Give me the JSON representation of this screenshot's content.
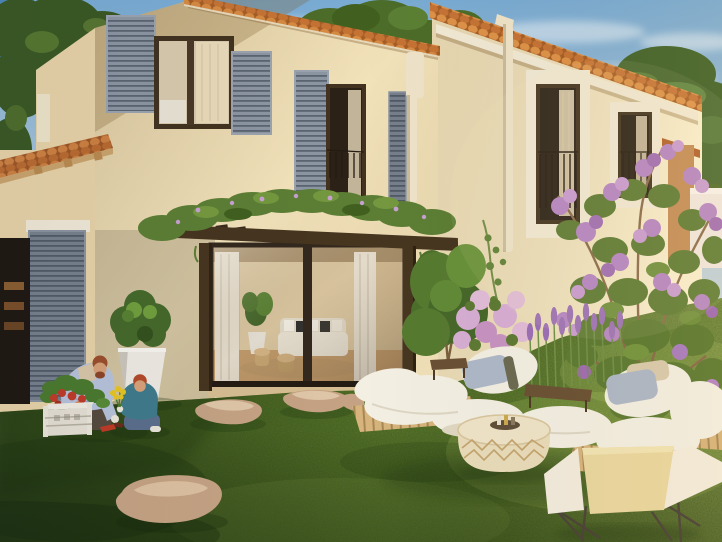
{
  "meta": {
    "type": "architectural-exterior-rendering",
    "description": "3D render of a cream Provencal villa with terracotta tile roof edges, grey louvred shutters, a plant-covered dark-wood pergola over sliding glass doors showing a lit living room, a lawn with stepping stones, a father and son planting flowers by a white crate planter and a tall white pot with a boxwood ball, and a low pallet lounge with white cushions, a woven pouf and a cream sling chair beside lavender and a purple flowering shrub under a blue sky with an umbrella pine."
  },
  "palette": {
    "sky_deep": "#4c88b8",
    "sky_top": "#79abd3",
    "sky_mid": "#b9cedd",
    "sky_horizon": "#e9e0cf",
    "cloud": "#ffffff",
    "tree_dark": "#3a5722",
    "tree_mid": "#4c6c29",
    "tree_light": "#5f8434",
    "pine_green": "#45662e",
    "wall_front": "#f2e2ba",
    "wall_side": "#e7d2a6",
    "wall_right": "#f7ecca",
    "roof_tile": "#cd8040",
    "roof_tile_dark": "#a35d28",
    "cornice": "#f1e9d4",
    "shutter_grey": "#8c95a2",
    "shutter_dark": "#767f8b",
    "window_frame": "#42321f",
    "window_glass": "#2b2117",
    "curtain": "#e9d9ba",
    "pipe": "#eee3c8",
    "pergola_wood": "#46351f",
    "pergola_plants": "#5c7e34",
    "interior_wall": "#d3bc94",
    "interior_floor": "#c29b6b",
    "grass_mid": "#55722a",
    "grass_dark": "#31491a",
    "grass_light": "#7e9a3c",
    "stone": "#c5a283",
    "planter_white": "#eeeae2",
    "bush_green": "#45682a",
    "skin": "#d8a178",
    "hair_man": "#9a4e2b",
    "hair_boy": "#b34a28",
    "shirt_man": "#b7c2da",
    "tee_man": "#d8c6a6",
    "pants_man": "#55493d",
    "shirt_boy": "#3f7b8b",
    "jeans_boy": "#5a6e8c",
    "crate_white": "#e5dfd2",
    "flower_red": "#c03a26",
    "flower_yellow": "#e7c51f",
    "pallet_wood": "#d6b47c",
    "wood_dark": "#6a5134",
    "cushion_white": "#f3efe3",
    "pillow_grey": "#aeb8c8",
    "pillow_beige": "#d9cbae",
    "pouf_cream": "#e9dcba",
    "pouf_pattern": "#c3a46e",
    "chair_cream": "#ead7a0",
    "chair_white": "#f3ecdd",
    "lavender": "#9b6fb6",
    "flower_purple": "#b584c4",
    "flower_pink": "#d7aed4",
    "shrub_green": "#5c7a33",
    "branch": "#8a6a4a",
    "garden_wall": "#f0e7e1",
    "distant_wall": "#c38a55"
  },
  "scene": {
    "sky": "clear blue sky fading to warm haze with soft thin clouds",
    "buildings": [
      {
        "name": "main-house",
        "detail": "two-storey cream facade, terracotta tile roof edge, two upper windows with grey louvred shutters, juliet railing, white downpipe"
      },
      {
        "name": "right-wing",
        "detail": "taller sunlit wing seen in perspective, white cornice under tiles, two tall white-trimmed windows with railings, white downpipe"
      },
      {
        "name": "left-annex",
        "detail": "low shed roof of terracotta tiles with flue, grey shutter and dark glazed door at garden level"
      },
      {
        "name": "pergola",
        "detail": "dark timber pergola covered with green planting and lilac blooms over bronze-framed sliding glass doors"
      },
      {
        "name": "interior",
        "detail": "warm living room behind glass: white sofa with black and white cushions, potted plant, timber stools, sheer curtains"
      },
      {
        "name": "distant",
        "detail": "ochre neighbouring building corner and low white garden wall at far right"
      }
    ],
    "people": [
      {
        "name": "father",
        "detail": "kneeling man in pale blue shirt with red-brown hair and beard, gardening gloves, planting"
      },
      {
        "name": "son",
        "detail": "kneeling red-haired boy in teal shirt and jeans holding yellow flowers"
      }
    ],
    "vegetation": [
      {
        "name": "boxwood-ball",
        "detail": "round clipped shrub in tall tapered white planter"
      },
      {
        "name": "crate-flowers",
        "detail": "white slatted crate planter with red and orange blooms"
      },
      {
        "name": "lavender",
        "detail": "purple flower spikes behind the lounge cushions"
      },
      {
        "name": "purple-shrub",
        "detail": "large crepe-myrtle type shrub with lilac clusters on the right"
      },
      {
        "name": "trees",
        "detail": "dark leafy tree upper left, trees behind the roofline, umbrella pine upper right"
      }
    ],
    "furniture": [
      {
        "name": "pallet-lounge",
        "detail": "low light-wood pallet platforms with plump white mattress cushions, grey-blue and beige lumbar pillows"
      },
      {
        "name": "pouf",
        "detail": "round woven cream pouf with tan diamond pattern used as table with small tray"
      },
      {
        "name": "sling-chair",
        "detail": "cream and white sling lounge chair on thin dark metal legs"
      }
    ],
    "ground": "green lawn, warm sunlight from the right, flat sandstone stepping stones"
  }
}
